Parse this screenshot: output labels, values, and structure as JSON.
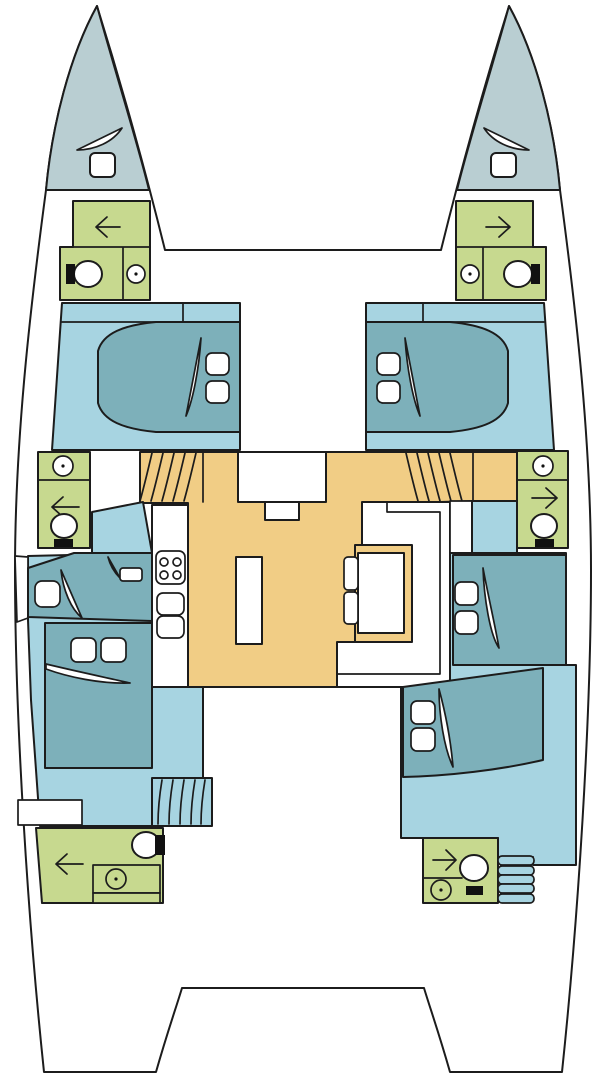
{
  "title": "Catamaran interior deck plan (top view, bows up)",
  "colors": {
    "outline": "#1c1c1c",
    "hull_white": "#ffffff",
    "bow_deck": "#b9ced2",
    "cabin_floor": "#a7d4e1",
    "bed_teal": "#7db0ba",
    "wet_room_green": "#c7d98f",
    "salon_floor_orange": "#f1cd85",
    "fixture_black": "#111111"
  },
  "areas": {
    "port_hull": [
      {
        "id": "port-bow-deck",
        "fixtures": [
          "windlass",
          "deck-hatch"
        ]
      },
      {
        "id": "port-forward-head",
        "fixtures": [
          "shower-arrow",
          "toilet",
          "sink"
        ]
      },
      {
        "id": "port-forward-cabin",
        "fixtures": [
          "double-bed",
          "pillows"
        ]
      },
      {
        "id": "port-mid-head",
        "fixtures": [
          "sink",
          "shower-arrow",
          "toilet"
        ]
      },
      {
        "id": "port-aft-cabin",
        "fixtures": [
          "single-berth",
          "double-bed",
          "pillows",
          "stairs"
        ]
      },
      {
        "id": "port-aft-head",
        "fixtures": [
          "toilet",
          "shower-arrow",
          "sink-counter"
        ]
      }
    ],
    "starboard_hull": [
      {
        "id": "starboard-bow-deck",
        "fixtures": [
          "windlass",
          "deck-hatch"
        ]
      },
      {
        "id": "starboard-forward-head",
        "fixtures": [
          "shower-arrow",
          "toilet",
          "sink"
        ]
      },
      {
        "id": "starboard-forward-cabin",
        "fixtures": [
          "double-bed",
          "pillows"
        ]
      },
      {
        "id": "starboard-mid-head",
        "fixtures": [
          "sink",
          "shower-arrow",
          "toilet"
        ]
      },
      {
        "id": "starboard-mid-cabin",
        "fixtures": [
          "double-bed",
          "pillows"
        ]
      },
      {
        "id": "starboard-aft-cabin",
        "fixtures": [
          "double-bed",
          "pillows"
        ]
      },
      {
        "id": "starboard-aft-head",
        "fixtures": [
          "shower-arrow",
          "toilet",
          "sink",
          "stairs"
        ]
      }
    ],
    "bridge_deck": [
      {
        "id": "salon",
        "fixtures": [
          "sideboard"
        ]
      },
      {
        "id": "galley",
        "fixtures": [
          "stove-4-burners",
          "double-sink",
          "island-counter"
        ]
      },
      {
        "id": "dinette",
        "fixtures": [
          "settee",
          "table",
          "two-chairs"
        ]
      },
      {
        "id": "port-companionway-stairs"
      },
      {
        "id": "starboard-companionway-stairs"
      },
      {
        "id": "aft-cockpit"
      }
    ]
  }
}
